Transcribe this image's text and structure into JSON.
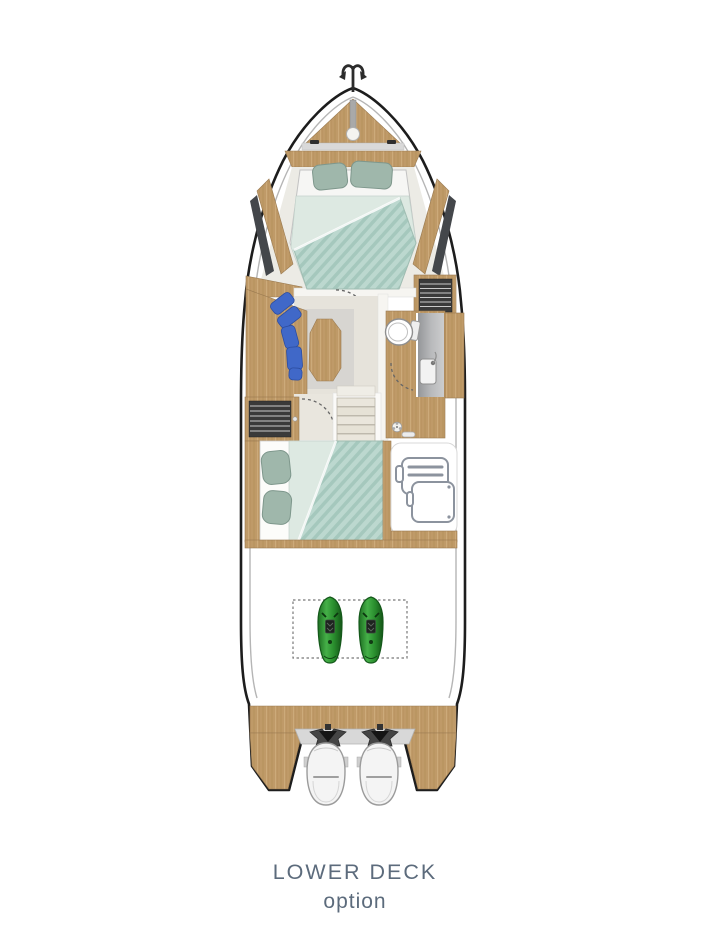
{
  "labels": {
    "deck": "LOWER DECK",
    "variant": "option"
  },
  "colors": {
    "text": "#5c6b7c",
    "hull_outline": "#1d1d1d",
    "wood": "#bf9a68",
    "wood_dark": "#9a7a50",
    "wood_grain": "#a9854f",
    "floor": "#e6e3db",
    "floor_light": "#d7d5d1",
    "mint": "#dde9e2",
    "teal": "#bcd8cf",
    "teal_stripe": "#a5c8bd",
    "sage": "#9fb7ab",
    "sofa_blue": "#4068c8",
    "shower_gray": "#a9abad",
    "dark_unit": "#3a3a3a",
    "seabob_green": "#2f9e33",
    "seabob_green_dark": "#1c6b1f",
    "engine_white": "#f4f4f4",
    "dash_gray": "#666666"
  },
  "icons": {
    "anchor": "anchor-icon",
    "windlass": "windlass-icon",
    "double_bed_forward": "double-bed-icon",
    "double_bed_mid": "double-bed-icon",
    "sofa_cushions": "sofa-cushions-icon",
    "table": "table-icon",
    "toilet": "toilet-icon",
    "sink": "sink-icon",
    "shower": "shower-icon",
    "wardrobe": "wardrobe-icon",
    "stairs": "stairs-icon",
    "luggage": "luggage-icon",
    "seabob": "seabob-icon",
    "outboard_engine": "outboard-engine-icon"
  }
}
